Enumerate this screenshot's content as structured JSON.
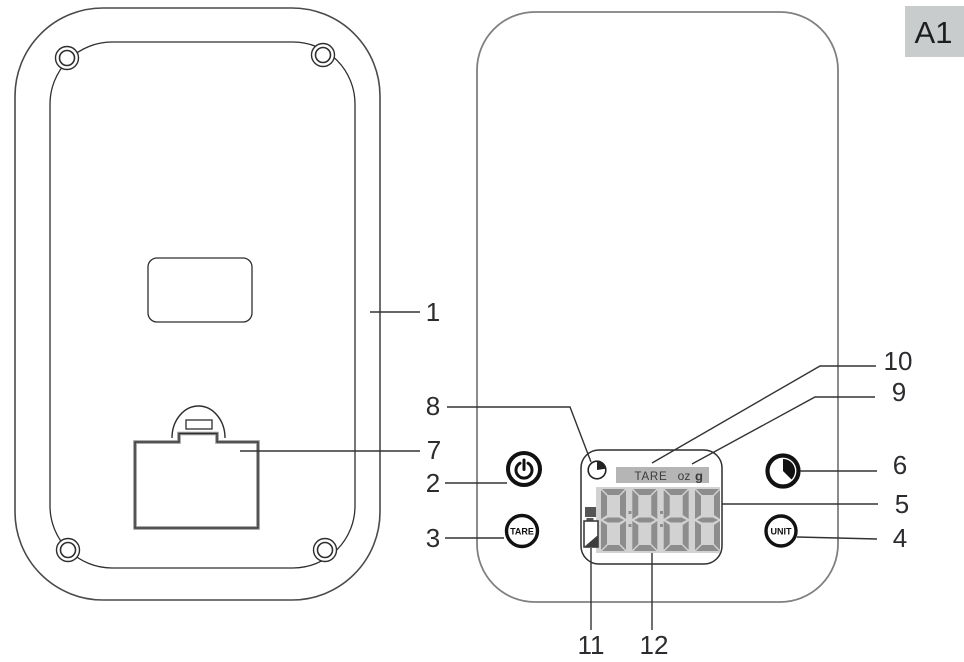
{
  "figure_label": "A1",
  "display": {
    "tare": "TARE",
    "oz": "oz",
    "g": "g",
    "digits": [
      "8",
      "8",
      "8",
      "8"
    ]
  },
  "buttons": {
    "tare": "TARE",
    "unit": "UNIT"
  },
  "callouts": [
    {
      "n": "1",
      "points_to": "rear-housing"
    },
    {
      "n": "2",
      "points_to": "power-button"
    },
    {
      "n": "3",
      "points_to": "tare-button"
    },
    {
      "n": "4",
      "points_to": "unit-button"
    },
    {
      "n": "5",
      "points_to": "lcd-display"
    },
    {
      "n": "6",
      "points_to": "pie-icon"
    },
    {
      "n": "7",
      "points_to": "battery-compartment"
    },
    {
      "n": "8",
      "points_to": "clock-icon"
    },
    {
      "n": "9",
      "points_to": "unit-indicators"
    },
    {
      "n": "10",
      "points_to": "tare-indicator"
    },
    {
      "n": "11",
      "points_to": "battery-indicator"
    },
    {
      "n": "12",
      "points_to": "digit-display"
    }
  ],
  "colors": {
    "lcd_panel": "#d2d2d2",
    "lcd_segment": "#8d8d8d",
    "indicator_bar": "#b5b5b5",
    "badge_bg": "#c9cccc",
    "outline_dark": "#2e2e2e",
    "outline_gray": "#808080"
  }
}
